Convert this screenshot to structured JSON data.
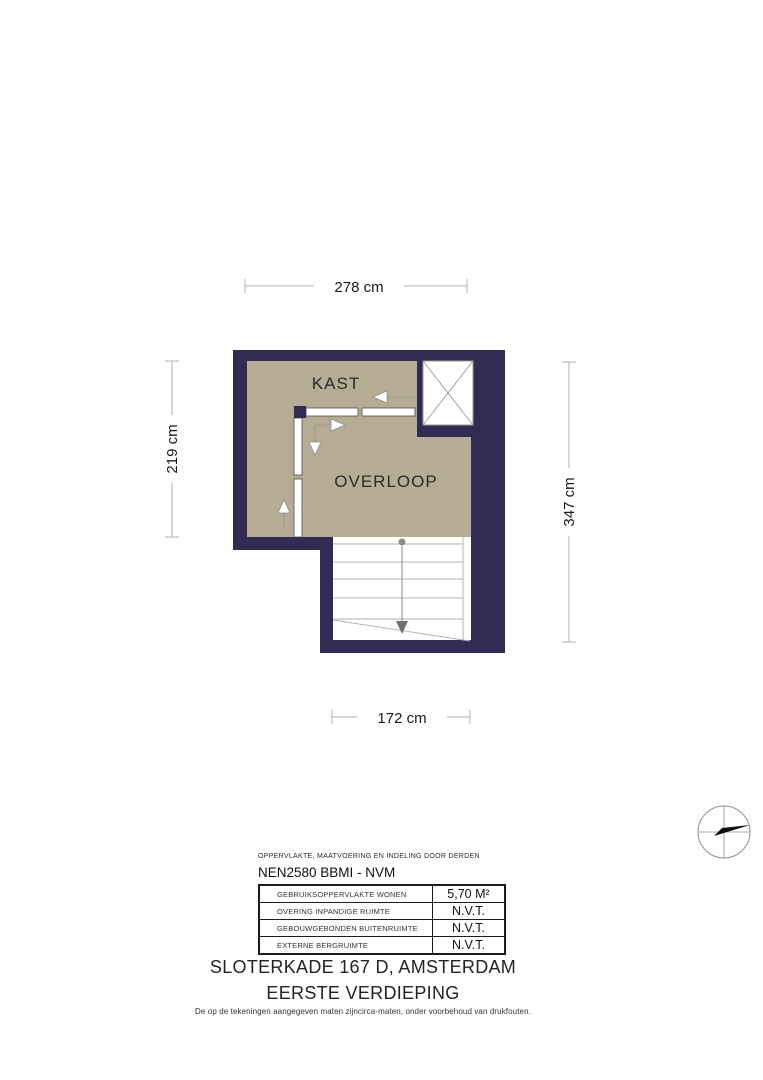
{
  "floorplan": {
    "rooms": [
      {
        "name": "KAST"
      },
      {
        "name": "OVERLOOP"
      }
    ],
    "dimensions": {
      "top": "278 cm",
      "left": "219 cm",
      "right": "347 cm",
      "bottom": "172 cm"
    },
    "colors": {
      "wall": "#322c55",
      "floor": "#b5ac93",
      "stairs": "#ffffff",
      "dimension_line": "#b0b0b0",
      "stair_arrow": "#8a8a8a",
      "compass_needle": "#0d0d0d"
    }
  },
  "legend": {
    "header": "OPPERVLAKTE, MAATVOERING EN INDELING DOOR DERDEN",
    "standard": "NEN2580 BBMI - NVM",
    "rows": [
      {
        "label": "GEBRUIKSOPPERVLAKTE WONEN",
        "value": "5,70 M²"
      },
      {
        "label": "OVERING INPANDIGE RUIMTE",
        "value": "N.V.T."
      },
      {
        "label": "GEBOUWGEBONDEN BUITENRUIMTE",
        "value": "N.V.T."
      },
      {
        "label": "EXTERNE BERGRUIMTE",
        "value": "N.V.T."
      }
    ]
  },
  "footer": {
    "address": "SLOTERKADE 167 D, AMSTERDAM",
    "floor": "EERSTE VERDIEPING",
    "disclaimer": "De op de tekeningen aangegeven maten zijncirca-maten, onder voorbehoud van drukfouten."
  }
}
